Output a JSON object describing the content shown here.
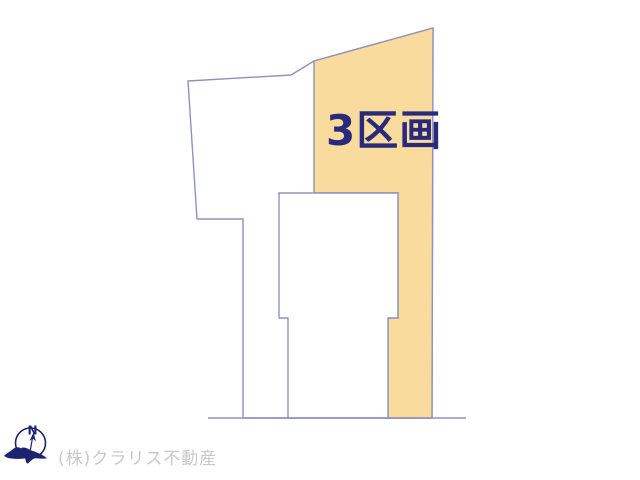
{
  "plot_map": {
    "highlight_label": "3区画"
  },
  "compass": {
    "north_label": "N"
  },
  "footer": {
    "company": "(株)クラリス不動産"
  },
  "colors": {
    "background": "#FFFFFF",
    "highlight_fill": "#F8DB9D",
    "outline": "#8F93BB",
    "label": "#2A2A7C",
    "compass": "#1C2470",
    "footer_text": "#C9C9C9"
  }
}
